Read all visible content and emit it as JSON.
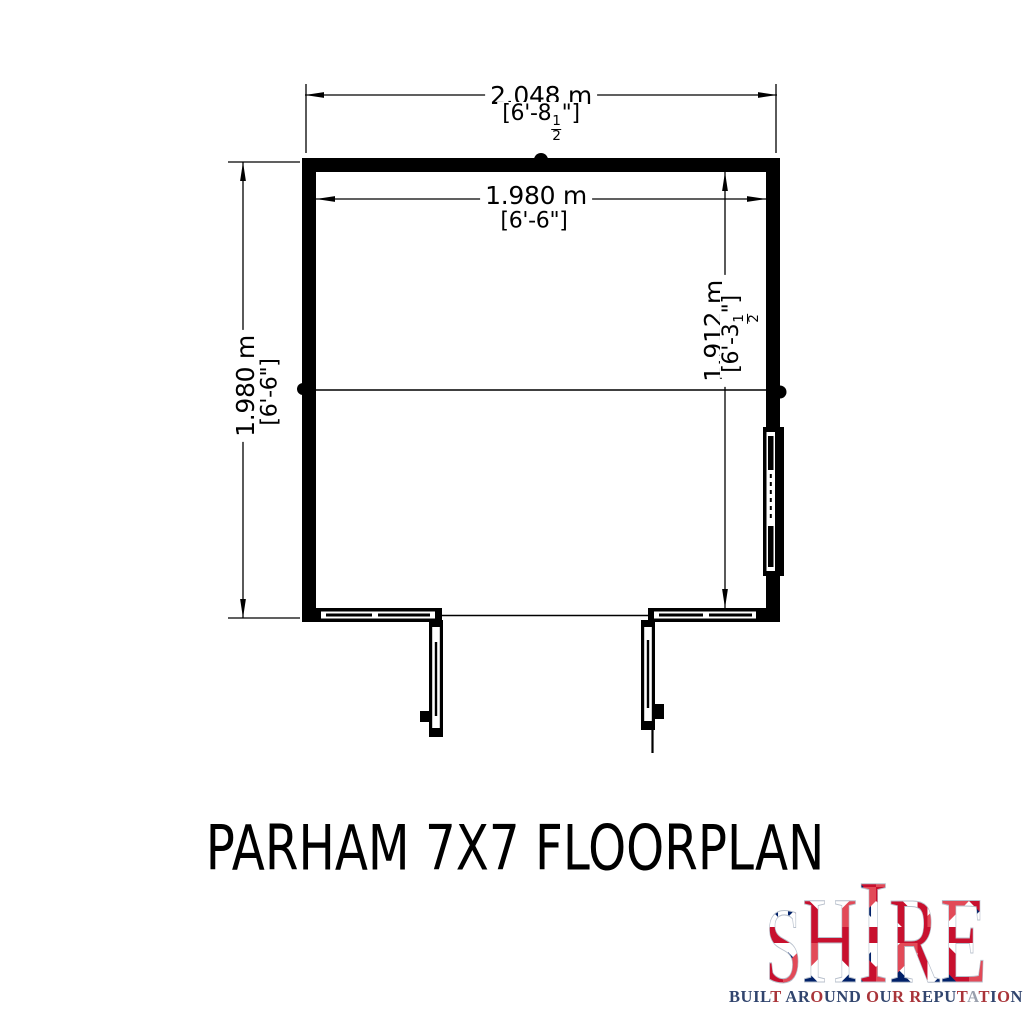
{
  "title": "PARHAM 7X7 FLOORPLAN",
  "dims": {
    "overall_width": {
      "metric": "2.048 m",
      "imperial_pre": "[6'-8",
      "imperial_num": "1",
      "imperial_den": "2",
      "imperial_post": "\"]"
    },
    "overall_depth": {
      "metric": "1.980 m",
      "imperial": "[6'-6\"]"
    },
    "inner_width": {
      "metric": "1.980 m",
      "imperial": "[6'-6\"]"
    },
    "inner_depth": {
      "metric": "1.912 m",
      "imperial_pre": "[6'-3",
      "imperial_num": "1",
      "imperial_den": "2",
      "imperial_post": "\"]"
    }
  },
  "plan_features": {
    "double_doors": "double-door opening, front wall, leaves shown open",
    "front_panel_left": "glazed/framed panel left of doors",
    "front_panel_right": "glazed/framed panel right of doors",
    "side_window": "window on right wall",
    "ridge_line": "roof ridge line across plan"
  },
  "logo": {
    "brand_letters": [
      "S",
      "H",
      "I",
      "R",
      "E"
    ],
    "tagline": "BUILT AROUND OUR REPUTATION",
    "tagline_letter_colors": [
      "#31456e",
      "#31456e",
      "#31456e",
      "#31456e",
      "#a93439",
      "#31456e",
      "#31456e",
      "#31456e",
      "#a93439",
      "#31456e",
      "#31456e",
      "#31456e",
      "#31456e",
      "#a93439",
      "#31456e",
      "#a93439",
      "#31456e",
      "#a93439",
      "#31456e",
      "#31456e",
      "#31456e",
      "#a93439",
      "#9aa0ad",
      "#a93439",
      "#31456e",
      "#a93439",
      "#31456e"
    ],
    "flag_red": "#c8102e",
    "flag_navy": "#012169",
    "flag_white": "#ffffff"
  },
  "colors": {
    "ink": "#000000",
    "background": "#ffffff"
  }
}
